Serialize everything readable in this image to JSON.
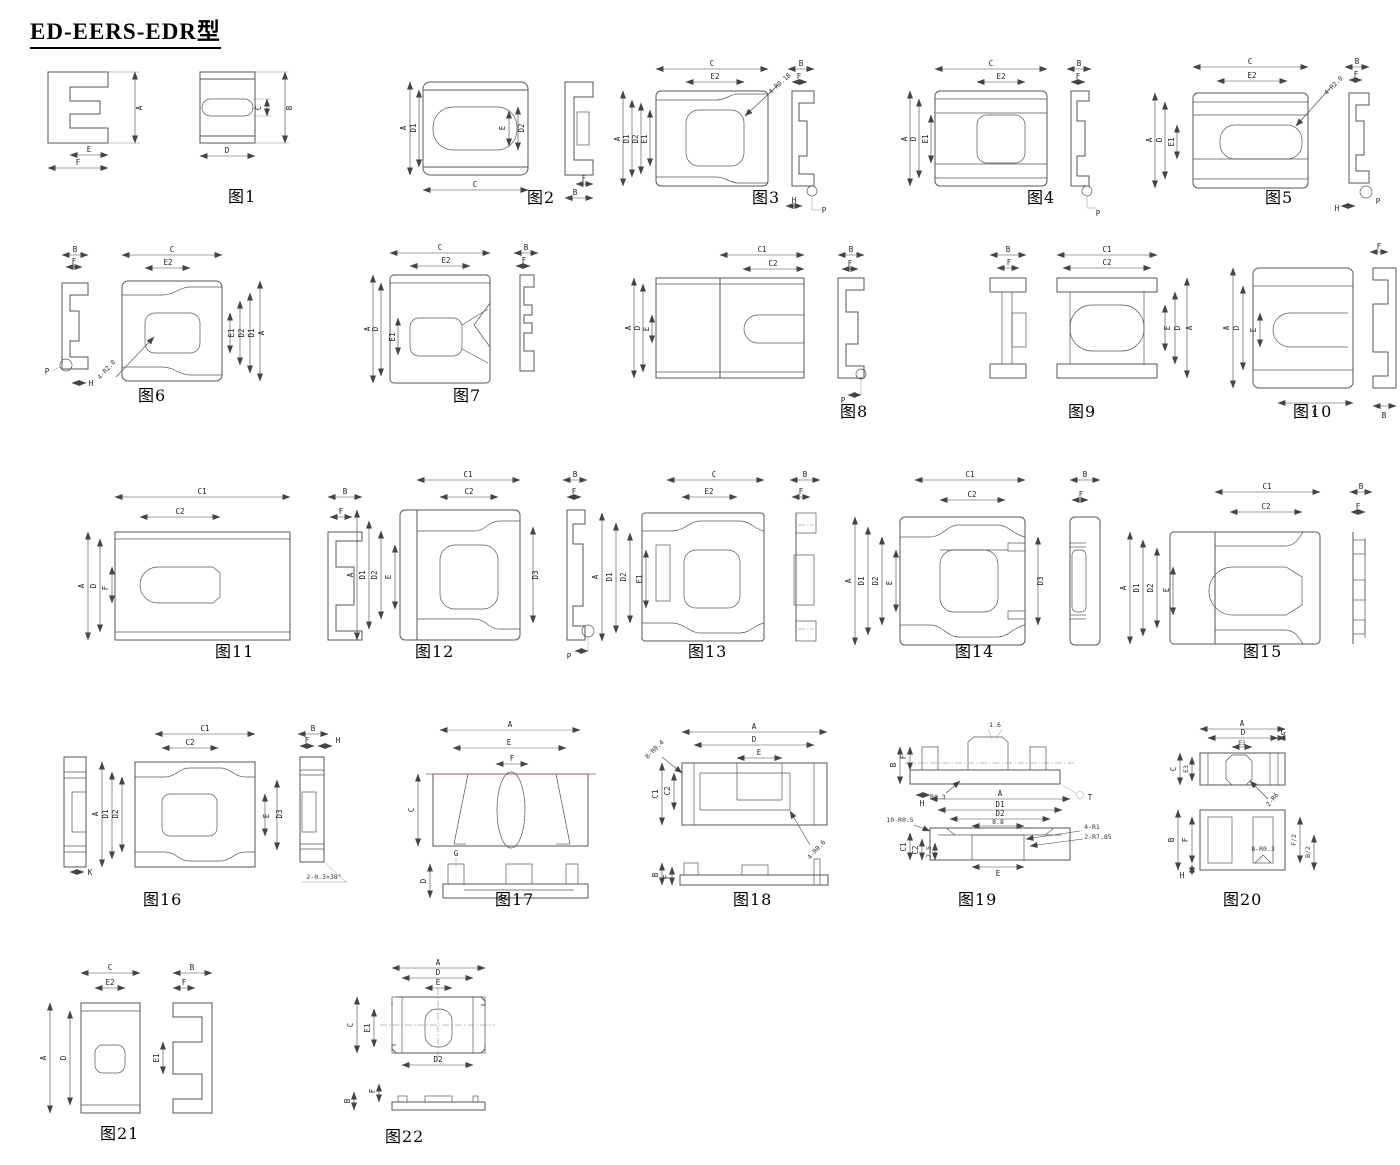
{
  "page": {
    "title": "ED-EERS-EDR型"
  },
  "figures": [
    {
      "caption": "图1",
      "labels": {
        "a": "A",
        "e": "E",
        "f": "F",
        "c": "C",
        "b": "B",
        "d": "D"
      }
    },
    {
      "caption": "图2",
      "labels": {
        "a": "A",
        "d1": "D1",
        "e": "E",
        "d2": "D2",
        "c": "C",
        "f": "F",
        "b": "B"
      }
    },
    {
      "caption": "图3",
      "labels": {
        "c": "C",
        "e2": "E2",
        "a": "A",
        "d1": "D1",
        "d2": "D2",
        "e1": "E1",
        "ann": "4-R0.18",
        "b": "B",
        "f": "F",
        "h": "H",
        "p": "P"
      }
    },
    {
      "caption": "图4",
      "labels": {
        "c": "C",
        "e2": "E2",
        "a": "A",
        "d": "D",
        "e1": "E1",
        "b": "B",
        "f": "F",
        "p": "P"
      }
    },
    {
      "caption": "图5",
      "labels": {
        "c": "C",
        "e2": "E2",
        "a": "A",
        "d": "D",
        "e1": "E1",
        "ann": "4-R2.0",
        "b": "B",
        "f": "F",
        "h": "H",
        "p": "P"
      }
    },
    {
      "caption": "图6",
      "labels": {
        "b": "B",
        "f": "F",
        "p": "P",
        "h": "H",
        "c": "C",
        "e2": "E2",
        "ann": "4-R2.0",
        "e1": "E1",
        "d2": "D2",
        "d1": "D1",
        "a": "A"
      }
    },
    {
      "caption": "图7",
      "labels": {
        "c": "C",
        "e2": "E2",
        "a": "A",
        "d": "D",
        "e1": "E1",
        "b": "B",
        "f": "F"
      }
    },
    {
      "caption": "图8",
      "labels": {
        "c1": "C1",
        "c2": "C2",
        "a": "A",
        "d": "D",
        "e": "E",
        "b": "B",
        "f": "F",
        "p": "P"
      }
    },
    {
      "caption": "图9",
      "labels": {
        "b": "B",
        "f": "F",
        "c1": "C1",
        "c2": "C2",
        "e": "E",
        "d": "D",
        "a": "A"
      }
    },
    {
      "caption": "图10",
      "labels": {
        "a": "A",
        "d": "D",
        "e": "E",
        "c": "C",
        "f": "F",
        "b": "B"
      }
    },
    {
      "caption": "图11",
      "labels": {
        "c1": "C1",
        "c2": "C2",
        "a": "A",
        "d": "D",
        "f_in": "F",
        "b": "B",
        "f": "F"
      }
    },
    {
      "caption": "图12",
      "labels": {
        "c1": "C1",
        "c2": "C2",
        "a": "A",
        "d1": "D1",
        "d2": "D2",
        "e": "E",
        "d3": "D3",
        "b": "B",
        "f": "F",
        "p": "P"
      }
    },
    {
      "caption": "图13",
      "labels": {
        "c": "C",
        "e2": "E2",
        "a": "A",
        "d1": "D1",
        "d2": "D2",
        "e1": "E1",
        "b": "B",
        "f": "F"
      }
    },
    {
      "caption": "图14",
      "labels": {
        "c1": "C1",
        "c2": "C2",
        "a": "A",
        "d1": "D1",
        "d2": "D2",
        "e": "E",
        "d3": "D3",
        "b": "B",
        "f": "F"
      }
    },
    {
      "caption": "图15",
      "labels": {
        "c1": "C1",
        "c2": "C2",
        "a": "A",
        "d1": "D1",
        "d2": "D2",
        "e": "E",
        "b": "B",
        "f": "F"
      }
    },
    {
      "caption": "图16",
      "labels": {
        "k": "K",
        "c1": "C1",
        "c2": "C2",
        "a": "A",
        "d1": "D1",
        "d2": "D2",
        "e": "E",
        "d3": "D3",
        "b": "B",
        "f": "F",
        "h": "H",
        "ann": "2-0.3×38°"
      }
    },
    {
      "caption": "图17",
      "labels": {
        "a": "A",
        "e": "E",
        "f": "F",
        "c": "C",
        "g": "G",
        "d": "D"
      }
    },
    {
      "caption": "图18",
      "labels": {
        "a": "A",
        "d": "D",
        "e": "E",
        "c1": "C1",
        "c2": "C2",
        "ann1": "8-R0.4",
        "ann2": "4-R0.6",
        "b": "B",
        "f": "F"
      }
    },
    {
      "caption": "图19",
      "labels": {
        "b": "B",
        "f": "F",
        "h": "H",
        "n16": "1.6",
        "r03": "R0.3",
        "t": "T",
        "a": "A",
        "d1": "D1",
        "d2": "D2",
        "n88": "8.8",
        "ann1": "10-R0.5",
        "ann2": "4-R1",
        "ann3": "2-R7.85",
        "c1": "C1",
        "c2": "C2",
        "n75": "7.5",
        "e": "E"
      }
    },
    {
      "caption": "图20",
      "labels": {
        "a": "A",
        "d": "D",
        "g": "G",
        "e1": "E1",
        "c": "C",
        "e3": "E3",
        "ann1": "2-R6",
        "b": "B",
        "f": "F",
        "h": "H",
        "ann2": "8-R0.3",
        "fh": "F/2",
        "bh": "B/2"
      }
    },
    {
      "caption": "图21",
      "labels": {
        "c": "C",
        "e2": "E2",
        "a": "A",
        "d": "D",
        "b": "B",
        "f": "F",
        "e1": "E1"
      }
    },
    {
      "caption": "图22",
      "labels": {
        "a": "A",
        "d": "D",
        "e": "E",
        "c": "C",
        "e1": "E1",
        "d2": "D2",
        "b": "B",
        "f": "F"
      }
    }
  ]
}
